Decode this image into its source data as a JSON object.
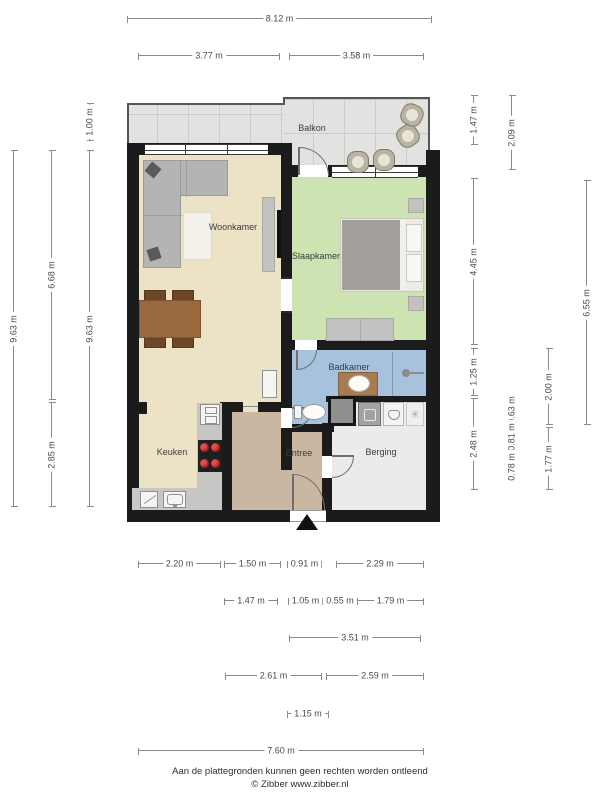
{
  "rooms": [
    {
      "name": "Balkon",
      "x": 312,
      "y": 128
    },
    {
      "name": "Woonkamer",
      "x": 233,
      "y": 227
    },
    {
      "name": "Slaapkamer",
      "x": 316,
      "y": 256
    },
    {
      "name": "Badkamer",
      "x": 349,
      "y": 367
    },
    {
      "name": "Keuken",
      "x": 172,
      "y": 452
    },
    {
      "name": "Entree",
      "x": 299,
      "y": 453
    },
    {
      "name": "Berging",
      "x": 381,
      "y": 452
    }
  ],
  "dimensions": [
    {
      "t": "8.12 m",
      "o": "h",
      "x": 127,
      "y": 18,
      "l": 305
    },
    {
      "t": "3.77 m",
      "o": "h",
      "x": 138,
      "y": 55,
      "l": 142
    },
    {
      "t": "3.58 m",
      "o": "h",
      "x": 289,
      "y": 55,
      "l": 135
    },
    {
      "t": "9.63 m",
      "o": "v",
      "x": 13,
      "y": 150,
      "l": 357
    },
    {
      "t": "6.68 m",
      "o": "v",
      "x": 51,
      "y": 150,
      "l": 250
    },
    {
      "t": "2.85 m",
      "o": "v",
      "x": 51,
      "y": 402,
      "l": 105
    },
    {
      "t": "1.00 m",
      "o": "v",
      "x": 89,
      "y": 103,
      "l": 38
    },
    {
      "t": "9.63 m",
      "o": "v",
      "x": 89,
      "y": 150,
      "l": 357
    },
    {
      "t": "1.47 m",
      "o": "v",
      "x": 473,
      "y": 95,
      "l": 50
    },
    {
      "t": "4.45 m",
      "o": "v",
      "x": 473,
      "y": 178,
      "l": 167
    },
    {
      "t": "1.25 m",
      "o": "v",
      "x": 473,
      "y": 348,
      "l": 48
    },
    {
      "t": "2.48 m",
      "o": "v",
      "x": 473,
      "y": 398,
      "l": 92
    },
    {
      "t": "2.09 m",
      "o": "v",
      "x": 511,
      "y": 95,
      "l": 75
    },
    {
      "t": "0.63 m",
      "o": "v",
      "x": 511,
      "y": 398,
      "l": 23
    },
    {
      "t": "0.81 m",
      "o": "v",
      "x": 511,
      "y": 423,
      "l": 28
    },
    {
      "t": "0.78 m",
      "o": "v",
      "x": 511,
      "y": 453,
      "l": 28
    },
    {
      "t": "2.00 m",
      "o": "v",
      "x": 548,
      "y": 348,
      "l": 77
    },
    {
      "t": "1.77 m",
      "o": "v",
      "x": 548,
      "y": 427,
      "l": 63
    },
    {
      "t": "6.55 m",
      "o": "v",
      "x": 586,
      "y": 180,
      "l": 245
    },
    {
      "t": "2.20 m",
      "o": "h",
      "x": 138,
      "y": 563,
      "l": 83
    },
    {
      "t": "1.50 m",
      "o": "h",
      "x": 224,
      "y": 563,
      "l": 57
    },
    {
      "t": "0.91 m",
      "o": "h",
      "x": 287,
      "y": 563,
      "l": 35
    },
    {
      "t": "2.29 m",
      "o": "h",
      "x": 336,
      "y": 563,
      "l": 88
    },
    {
      "t": "1.47 m",
      "o": "h",
      "x": 224,
      "y": 600,
      "l": 54
    },
    {
      "t": "1.05 m",
      "o": "h",
      "x": 288,
      "y": 600,
      "l": 35
    },
    {
      "t": "0.55 m",
      "o": "h",
      "x": 325,
      "y": 600,
      "l": 30
    },
    {
      "t": "1.79 m",
      "o": "h",
      "x": 357,
      "y": 600,
      "l": 67
    },
    {
      "t": "3.51 m",
      "o": "h",
      "x": 289,
      "y": 637,
      "l": 132
    },
    {
      "t": "2.61 m",
      "o": "h",
      "x": 225,
      "y": 675,
      "l": 97
    },
    {
      "t": "2.59 m",
      "o": "h",
      "x": 326,
      "y": 675,
      "l": 98
    },
    {
      "t": "1.15 m",
      "o": "h",
      "x": 287,
      "y": 713,
      "l": 42
    },
    {
      "t": "7.60 m",
      "o": "h",
      "x": 138,
      "y": 750,
      "l": 286
    }
  ],
  "footer": {
    "line1": "Aan de plattegronden kunnen geen rechten worden ontleend",
    "line2": "© Zibber www.zibber.nl"
  },
  "colors": {
    "wall": "#1b1b1b",
    "living_floor": "#ece2c6",
    "bedroom_floor": "#cde4b2",
    "bathroom_floor": "#a6c2dc",
    "hall_floor": "#c9b7a2",
    "storage_floor": "#ebebe9",
    "balcony_floor": "#e2e2e0",
    "burner_red": "#b02525",
    "dimension_line": "#8a8a8a"
  }
}
